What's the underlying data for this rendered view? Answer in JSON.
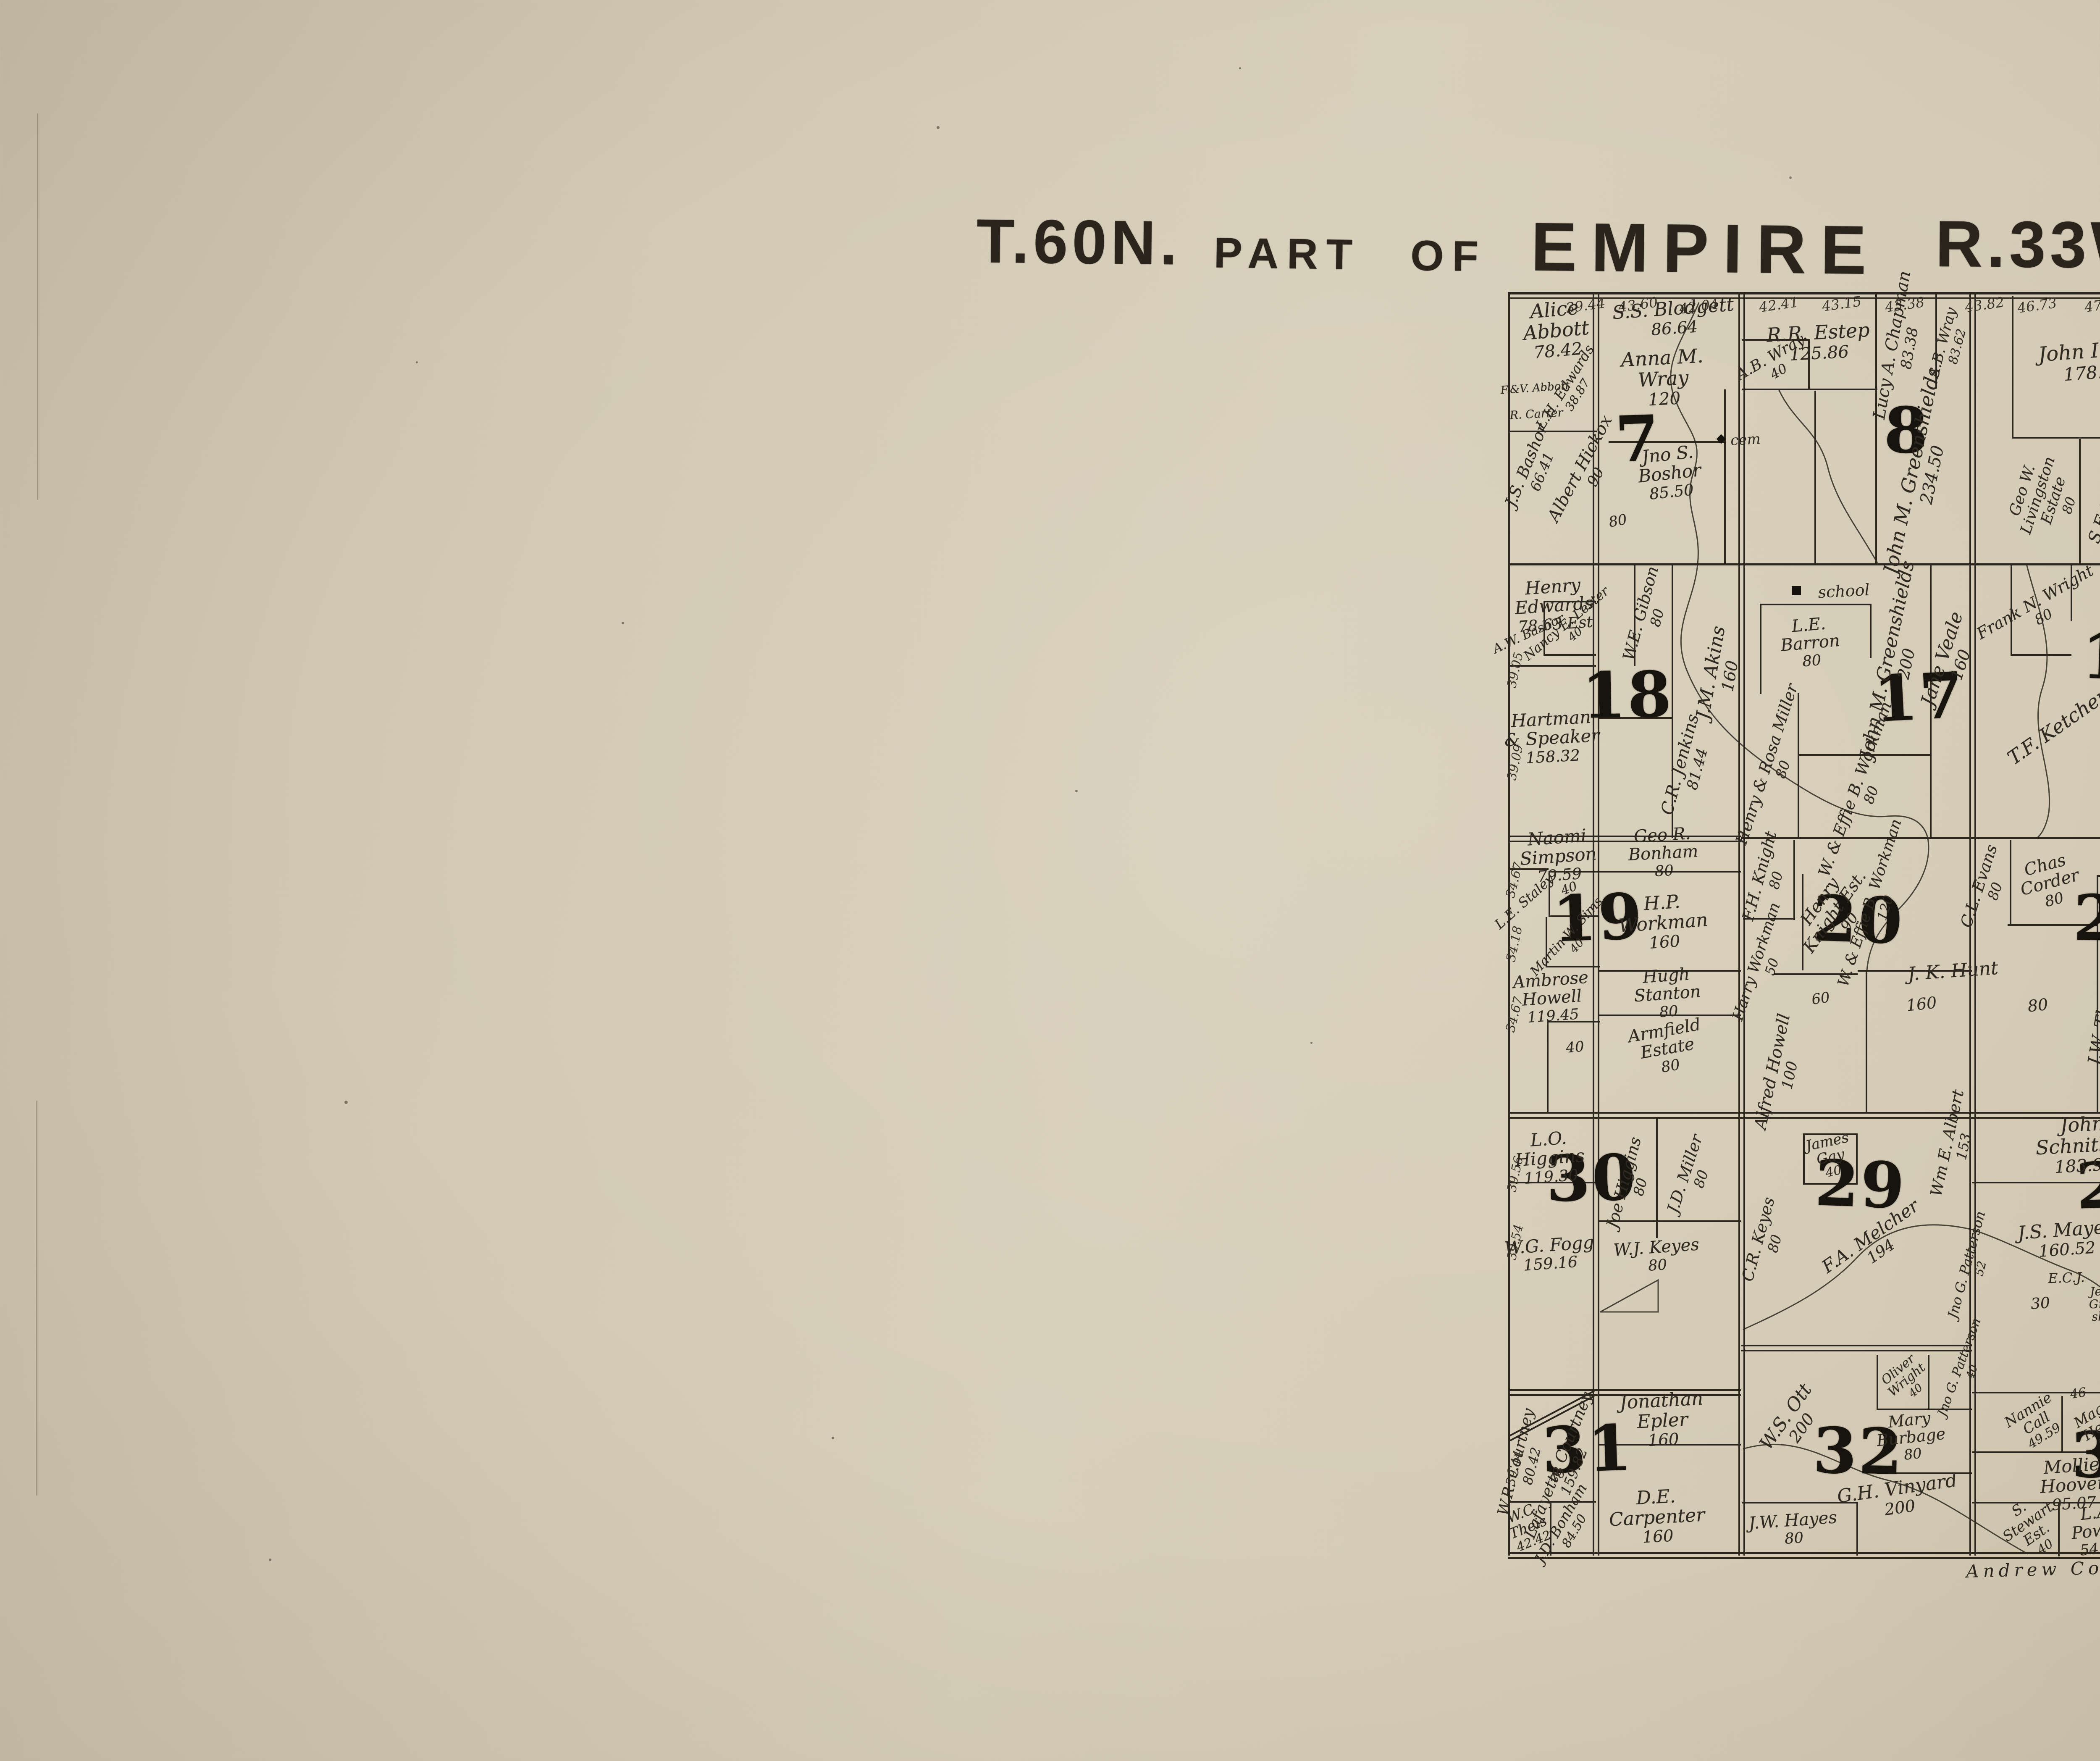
{
  "title": {
    "township": "T.60N.",
    "part_of": "PART OF",
    "name": "EMPIRE",
    "range": "R.33W."
  },
  "labels": {
    "school": "school",
    "cem": "cem",
    "county": "Andrew Co Mo"
  },
  "edge": {
    "top": [
      "39.44",
      "43.60",
      "42.04",
      "42.41",
      "43.15",
      "43.38",
      "43.82",
      "46.73",
      "47.08"
    ],
    "left": [
      "39.05",
      "39.09",
      "34.67",
      "34.18",
      "34.67",
      "39.56",
      "39.54",
      "39.44"
    ]
  },
  "nums": [
    "80",
    "160",
    "80",
    "40",
    "40",
    "40",
    "46",
    "30",
    "60"
  ],
  "sections": [
    {
      "number": "7",
      "parcels": [
        {
          "name": "Alice Abbott",
          "acres": "78.42"
        },
        {
          "name": "F.&V. Abbott",
          "acres": ""
        },
        {
          "name": "R. Carter",
          "acres": ""
        },
        {
          "name": "L.H. Edwards",
          "acres": "38.87"
        },
        {
          "name": "J.S. Bashor",
          "acres": "66.41"
        },
        {
          "name": "Albert Hickox",
          "acres": "90"
        },
        {
          "name": "Anna M. Wray",
          "acres": "120"
        },
        {
          "name": "S.S. Blodgett",
          "acres": "86.64"
        },
        {
          "name": "Jno S. Boshor",
          "acres": "85.50"
        }
      ]
    },
    {
      "number": "8",
      "parcels": [
        {
          "name": "R.R. Estep",
          "acres": "125.86"
        },
        {
          "name": "A.B. Wray",
          "acres": "40"
        },
        {
          "name": "Lucy A. Chapman",
          "acres": "83.38"
        },
        {
          "name": "A.B. Wray",
          "acres": "83.62"
        },
        {
          "name": "John M. Greenshields",
          "acres": "234.50"
        }
      ]
    },
    {
      "number": "9",
      "parcels": [
        {
          "name": "John Inglis",
          "acres": "178.31"
        },
        {
          "name": "Geo W. Livingston Estate",
          "acres": "80"
        },
        {
          "name": "S.F. Tedford",
          "acres": "90.23"
        }
      ]
    },
    {
      "number": "18",
      "parcels": [
        {
          "name": "Henry Edwards",
          "acres": "78.63 Est"
        },
        {
          "name": "A.W. Bashor",
          "acres": ""
        },
        {
          "name": "Nancy E. Lester",
          "acres": "40"
        },
        {
          "name": "Hartman & Speaker",
          "acres": "158.32"
        },
        {
          "name": "W.E. Gibson",
          "acres": "80"
        },
        {
          "name": "C.R. Jenkins",
          "acres": "81.44"
        },
        {
          "name": "J.M. Akins",
          "acres": "160"
        }
      ]
    },
    {
      "number": "17",
      "parcels": [
        {
          "name": "L.E. Barron",
          "acres": "80"
        },
        {
          "name": "John M. Greenshields",
          "acres": "200"
        },
        {
          "name": "Henry & Rosa Miller",
          "acres": "80"
        },
        {
          "name": "W. & Effie B. Workman",
          "acres": "80"
        },
        {
          "name": "Jane Veale",
          "acres": "160"
        }
      ]
    },
    {
      "number": "16",
      "parcels": [
        {
          "name": "Frank N. Wright",
          "acres": "80"
        },
        {
          "name": "T.F. Ketchem & Wife",
          "acres": ""
        }
      ]
    },
    {
      "number": "19",
      "parcels": [
        {
          "name": "Naomi Simpson",
          "acres": "79.59"
        },
        {
          "name": "L.E. Staley",
          "acres": ""
        },
        {
          "name": "Martin W. Sims",
          "acres": "40"
        },
        {
          "name": "H.P. Workman",
          "acres": "160"
        },
        {
          "name": "Geo R. Bonham",
          "acres": "80"
        },
        {
          "name": "Ambrose Howell",
          "acres": "119.45"
        },
        {
          "name": "Hugh Stanton",
          "acres": "80"
        },
        {
          "name": "Armfield Estate",
          "acres": "80"
        }
      ]
    },
    {
      "number": "20",
      "parcels": [
        {
          "name": "F.H. Knight",
          "acres": "80"
        },
        {
          "name": "Henry Knight Est.",
          "acres": "90"
        },
        {
          "name": "Harry Workman",
          "acres": "50"
        },
        {
          "name": "Alfred Howell",
          "acres": "100"
        },
        {
          "name": "W. & Effie B. Workman",
          "acres": "120"
        },
        {
          "name": "J. K. Hunt",
          "acres": ""
        }
      ]
    },
    {
      "number": "21",
      "parcels": [
        {
          "name": "C.L. Evans",
          "acres": "80"
        },
        {
          "name": "Chas Corder",
          "acres": "80"
        },
        {
          "name": "Frank Pierce",
          "acres": "47.49"
        },
        {
          "name": "J.W. Thompson Est",
          "acres": "148"
        }
      ]
    },
    {
      "number": "30",
      "parcels": [
        {
          "name": "L.O. Higgins",
          "acres": "119.30"
        },
        {
          "name": "W.G. Fogg",
          "acres": "159.16"
        },
        {
          "name": "Joe Higgins",
          "acres": "80"
        },
        {
          "name": "J.D. Miller",
          "acres": "80"
        },
        {
          "name": "W.J. Keyes",
          "acres": "80"
        }
      ]
    },
    {
      "number": "29",
      "parcels": [
        {
          "name": "James Gay",
          "acres": "40"
        },
        {
          "name": "C.R. Keyes",
          "acres": "80"
        },
        {
          "name": "F.A. Melcher",
          "acres": "194"
        },
        {
          "name": "Wm E. Albert",
          "acres": "153"
        },
        {
          "name": "Jno G. Patterson",
          "acres": "52"
        }
      ]
    },
    {
      "number": "28",
      "parcels": [
        {
          "name": "John Schnitker",
          "acres": "183.90"
        },
        {
          "name": "J.S. Mayes",
          "acres": "160.52"
        },
        {
          "name": "E.C.J.",
          "acres": ""
        },
        {
          "name": "T.O.H.",
          "acres": ""
        },
        {
          "name": "Jennie Green-shield",
          "acres": ""
        }
      ]
    },
    {
      "number": "31",
      "parcels": [
        {
          "name": "W.R. Courtney",
          "acres": "80.42"
        },
        {
          "name": "Lafayette Courtney",
          "acres": "159.82"
        },
        {
          "name": "W.C. Theis",
          "acres": "42.42"
        },
        {
          "name": "J.D. Bonham",
          "acres": "84.50"
        },
        {
          "name": "Jonathan Epler",
          "acres": "160"
        },
        {
          "name": "D.E. Carpenter",
          "acres": "160"
        }
      ]
    },
    {
      "number": "32",
      "parcels": [
        {
          "name": "W.S. Ott",
          "acres": "200"
        },
        {
          "name": "Oliver Wright",
          "acres": "40"
        },
        {
          "name": "Jno G. Patterson",
          "acres": "40"
        },
        {
          "name": "Mary Burbage",
          "acres": "80"
        },
        {
          "name": "G.H. Vinyard",
          "acres": "200"
        },
        {
          "name": "J.W. Hayes",
          "acres": "80"
        }
      ]
    },
    {
      "number": "33",
      "parcels": [
        {
          "name": "Nannie Call",
          "acres": "49.59"
        },
        {
          "name": "Maggie Herron",
          "acres": "53.59"
        },
        {
          "name": "Mollie Hoover",
          "acres": "95.07"
        },
        {
          "name": "S. Stewart Est.",
          "acres": "40"
        },
        {
          "name": "L.A. Powell",
          "acres": "54.17"
        }
      ]
    }
  ]
}
